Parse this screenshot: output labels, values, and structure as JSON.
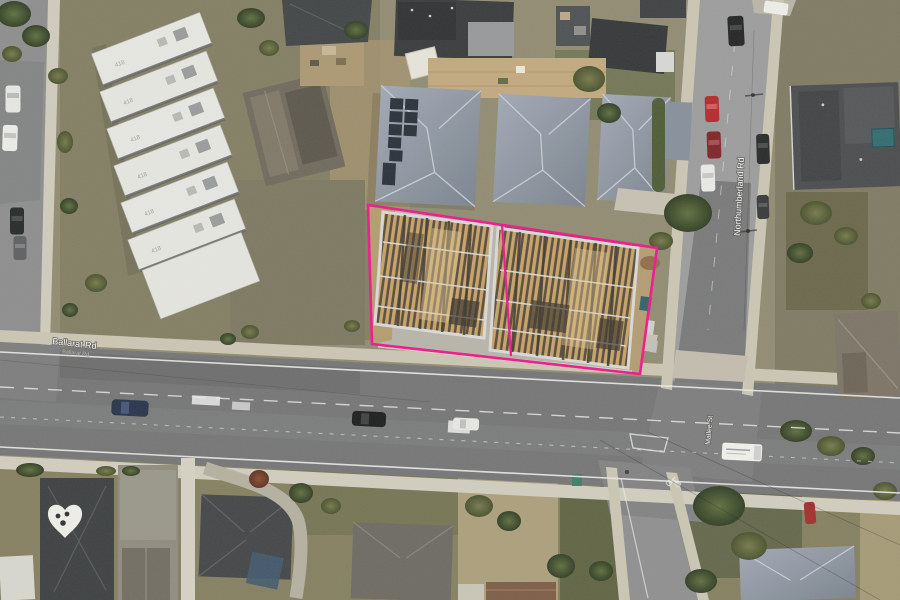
{
  "streets": {
    "main_road_label": "Ballarat Rd",
    "cross_road_label": "Northumberland Rd",
    "south_road_label": "Mallee St"
  },
  "complex": {
    "roof_numbers": [
      "418",
      "418",
      "418",
      "418",
      "418",
      "418"
    ]
  },
  "site_boundary": {
    "color": "#f2118c"
  }
}
